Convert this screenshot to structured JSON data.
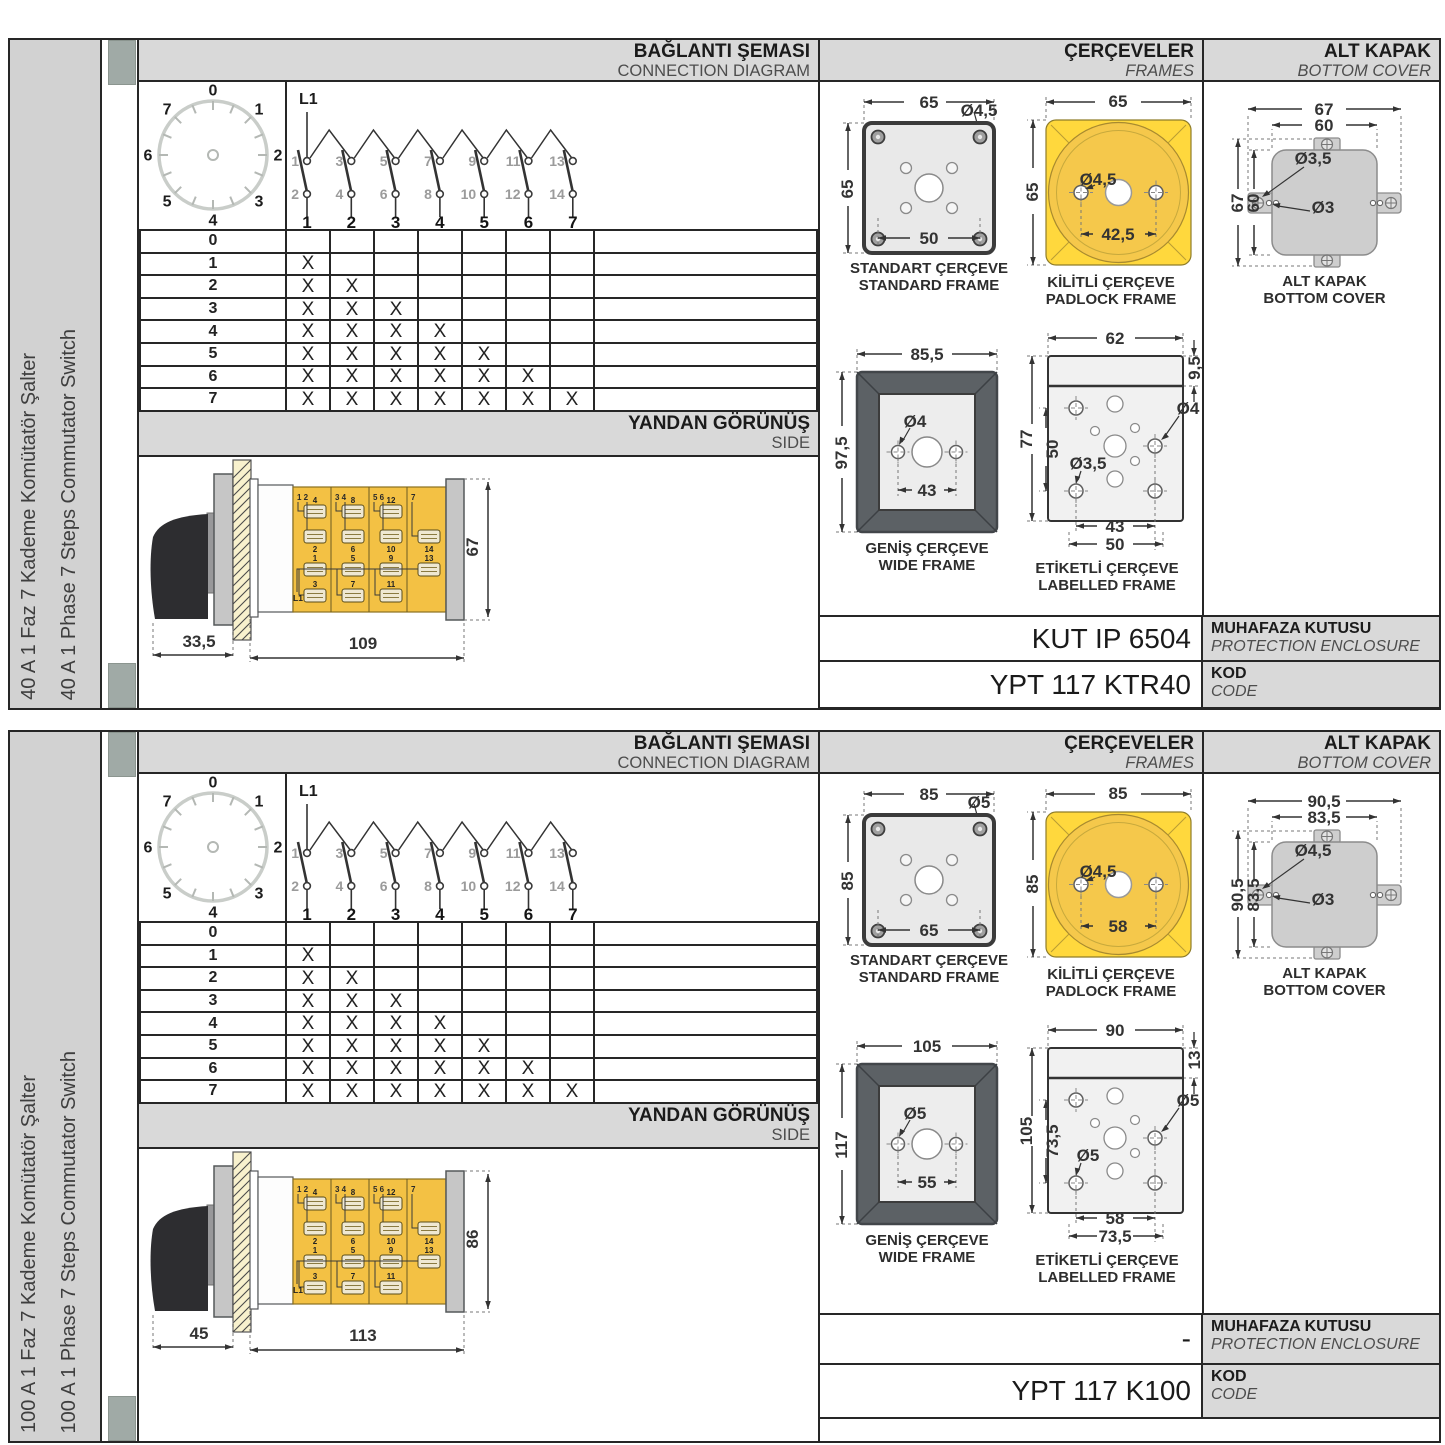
{
  "sections": [
    {
      "sidebar": {
        "title_tr": "40 A 1 Faz 7 Kademe Komütatör Şalter",
        "title_en": "40 A 1 Phase 7 Steps Commutator Switch"
      },
      "headers": {
        "connection_tr": "BAĞLANTI ŞEMASI",
        "connection_en": "CONNECTION DIAGRAM",
        "frames_tr": "ÇERÇEVELER",
        "frames_en": "FRAMES",
        "cover_tr": "ALT KAPAK",
        "cover_en": "BOTTOM COVER",
        "side_tr": "YANDAN GÖRÜNÜŞ",
        "side_en": "SIDE"
      },
      "dial": {
        "numbers": [
          "0",
          "1",
          "2",
          "3",
          "4",
          "5",
          "6",
          "7"
        ]
      },
      "connection": {
        "source": "L1",
        "top_contacts": [
          "1",
          "3",
          "5",
          "7",
          "9",
          "11",
          "13"
        ],
        "bottom_contacts": [
          "2",
          "4",
          "6",
          "8",
          "10",
          "12",
          "14"
        ],
        "outputs": [
          "1",
          "2",
          "3",
          "4",
          "5",
          "6",
          "7"
        ]
      },
      "table": {
        "mark": "X",
        "rows": [
          {
            "label": "0",
            "cols": [
              0,
              0,
              0,
              0,
              0,
              0,
              0
            ]
          },
          {
            "label": "1",
            "cols": [
              1,
              0,
              0,
              0,
              0,
              0,
              0
            ]
          },
          {
            "label": "2",
            "cols": [
              1,
              1,
              0,
              0,
              0,
              0,
              0
            ]
          },
          {
            "label": "3",
            "cols": [
              1,
              1,
              1,
              0,
              0,
              0,
              0
            ]
          },
          {
            "label": "4",
            "cols": [
              1,
              1,
              1,
              1,
              0,
              0,
              0
            ]
          },
          {
            "label": "5",
            "cols": [
              1,
              1,
              1,
              1,
              1,
              0,
              0
            ]
          },
          {
            "label": "6",
            "cols": [
              1,
              1,
              1,
              1,
              1,
              1,
              0
            ]
          },
          {
            "label": "7",
            "cols": [
              1,
              1,
              1,
              1,
              1,
              1,
              1
            ]
          }
        ]
      },
      "side_view": {
        "dim_front": "33,5",
        "dim_body": "109",
        "dim_height": "67",
        "line_label": "L1",
        "modules": [
          {
            "head": "1 2",
            "t1": "4",
            "t2": "2",
            "t3": "1",
            "t4": "3"
          },
          {
            "head": "3 4",
            "t1": "8",
            "t2": "6",
            "t3": "5",
            "t4": "7"
          },
          {
            "head": "5 6",
            "t1": "12",
            "t2": "10",
            "t3": "9",
            "t4": "11"
          },
          {
            "head": "7",
            "t1": "",
            "t2": "14",
            "t3": "13",
            "t4": ""
          }
        ]
      },
      "frames": {
        "standard": {
          "caption_tr": "STANDART ÇERÇEVE",
          "caption_en": "STANDARD FRAME",
          "dim_w": "65",
          "dim_h": "65",
          "dim_holes": "50",
          "dia": "Ø4,5"
        },
        "padlock": {
          "caption_tr": "KİLİTLİ ÇERÇEVE",
          "caption_en": "PADLOCK FRAME",
          "dim_w": "65",
          "dim_h": "65",
          "dim_holes": "42,5",
          "dia": "Ø4,5"
        },
        "wide": {
          "caption_tr": "GENİŞ ÇERÇEVE",
          "caption_en": "WIDE FRAME",
          "dim_w": "85,5",
          "dim_h": "97,5",
          "dim_holes": "43",
          "dia": "Ø4"
        },
        "labelled": {
          "caption_tr": "ETİKETLİ ÇERÇEVE",
          "caption_en": "LABELLED FRAME",
          "dim_w": "62",
          "dim_label": "9,5",
          "dim_h": "77",
          "dim_inner": "50",
          "dia_right": "Ø4",
          "dia_left": "Ø3,5",
          "dim_b1": "43",
          "dim_b2": "50"
        }
      },
      "cover": {
        "caption_tr": "ALT KAPAK",
        "caption_en": "BOTTOM COVER",
        "ow": "67",
        "iw": "60",
        "oh": "67",
        "ih": "60",
        "dia_tab": "Ø3,5",
        "dia_small": "Ø3"
      },
      "codes": {
        "enclosure_value": "KUT IP 6504",
        "enclosure_label_tr": "MUHAFAZA KUTUSU",
        "enclosure_label_en": "PROTECTION ENCLOSURE",
        "code_value": "YPT 117 KTR40",
        "code_label_tr": "KOD",
        "code_label_en": "CODE"
      }
    },
    {
      "sidebar": {
        "title_tr": "100 A 1 Faz 7 Kademe Komütatör Şalter",
        "title_en": "100 A 1 Phase 7 Steps Commutator Switch"
      },
      "headers": {
        "connection_tr": "BAĞLANTI ŞEMASI",
        "connection_en": "CONNECTION DIAGRAM",
        "frames_tr": "ÇERÇEVELER",
        "frames_en": "FRAMES",
        "cover_tr": "ALT KAPAK",
        "cover_en": "BOTTOM COVER",
        "side_tr": "YANDAN GÖRÜNÜŞ",
        "side_en": "SIDE"
      },
      "dial": {
        "numbers": [
          "0",
          "1",
          "2",
          "3",
          "4",
          "5",
          "6",
          "7"
        ]
      },
      "connection": {
        "source": "L1",
        "top_contacts": [
          "1",
          "3",
          "5",
          "7",
          "9",
          "11",
          "13"
        ],
        "bottom_contacts": [
          "2",
          "4",
          "6",
          "8",
          "10",
          "12",
          "14"
        ],
        "outputs": [
          "1",
          "2",
          "3",
          "4",
          "5",
          "6",
          "7"
        ]
      },
      "table": {
        "mark": "X",
        "rows": [
          {
            "label": "0",
            "cols": [
              0,
              0,
              0,
              0,
              0,
              0,
              0
            ]
          },
          {
            "label": "1",
            "cols": [
              1,
              0,
              0,
              0,
              0,
              0,
              0
            ]
          },
          {
            "label": "2",
            "cols": [
              1,
              1,
              0,
              0,
              0,
              0,
              0
            ]
          },
          {
            "label": "3",
            "cols": [
              1,
              1,
              1,
              0,
              0,
              0,
              0
            ]
          },
          {
            "label": "4",
            "cols": [
              1,
              1,
              1,
              1,
              0,
              0,
              0
            ]
          },
          {
            "label": "5",
            "cols": [
              1,
              1,
              1,
              1,
              1,
              0,
              0
            ]
          },
          {
            "label": "6",
            "cols": [
              1,
              1,
              1,
              1,
              1,
              1,
              0
            ]
          },
          {
            "label": "7",
            "cols": [
              1,
              1,
              1,
              1,
              1,
              1,
              1
            ]
          }
        ]
      },
      "side_view": {
        "dim_front": "45",
        "dim_body": "113",
        "dim_height": "86",
        "line_label": "L1",
        "modules": [
          {
            "head": "1 2",
            "t1": "4",
            "t2": "2",
            "t3": "1",
            "t4": "3"
          },
          {
            "head": "3 4",
            "t1": "8",
            "t2": "6",
            "t3": "5",
            "t4": "7"
          },
          {
            "head": "5 6",
            "t1": "12",
            "t2": "10",
            "t3": "9",
            "t4": "11"
          },
          {
            "head": "7",
            "t1": "",
            "t2": "14",
            "t3": "13",
            "t4": ""
          }
        ]
      },
      "frames": {
        "standard": {
          "caption_tr": "STANDART ÇERÇEVE",
          "caption_en": "STANDARD FRAME",
          "dim_w": "85",
          "dim_h": "85",
          "dim_holes": "65",
          "dia": "Ø5"
        },
        "padlock": {
          "caption_tr": "KİLİTLİ ÇERÇEVE",
          "caption_en": "PADLOCK FRAME",
          "dim_w": "85",
          "dim_h": "85",
          "dim_holes": "58",
          "dia": "Ø4,5"
        },
        "wide": {
          "caption_tr": "GENİŞ ÇERÇEVE",
          "caption_en": "WIDE FRAME",
          "dim_w": "105",
          "dim_h": "117",
          "dim_holes": "55",
          "dia": "Ø5"
        },
        "labelled": {
          "caption_tr": "ETİKETLİ ÇERÇEVE",
          "caption_en": "LABELLED FRAME",
          "dim_w": "90",
          "dim_label": "13",
          "dim_h": "105",
          "dim_inner": "73,5",
          "dia_right": "Ø5",
          "dia_left": "Ø5",
          "dim_b1": "58",
          "dim_b2": "73,5"
        }
      },
      "cover": {
        "caption_tr": "ALT KAPAK",
        "caption_en": "BOTTOM COVER",
        "ow": "90,5",
        "iw": "83,5",
        "oh": "90,5",
        "ih": "83,5",
        "dia_tab": "Ø4,5",
        "dia_small": "Ø3"
      },
      "codes": {
        "enclosure_value": "-",
        "enclosure_label_tr": "MUHAFAZA KUTUSU",
        "enclosure_label_en": "PROTECTION ENCLOSURE",
        "code_value": "YPT 117 K100",
        "code_label_tr": "KOD",
        "code_label_en": "CODE"
      }
    }
  ]
}
